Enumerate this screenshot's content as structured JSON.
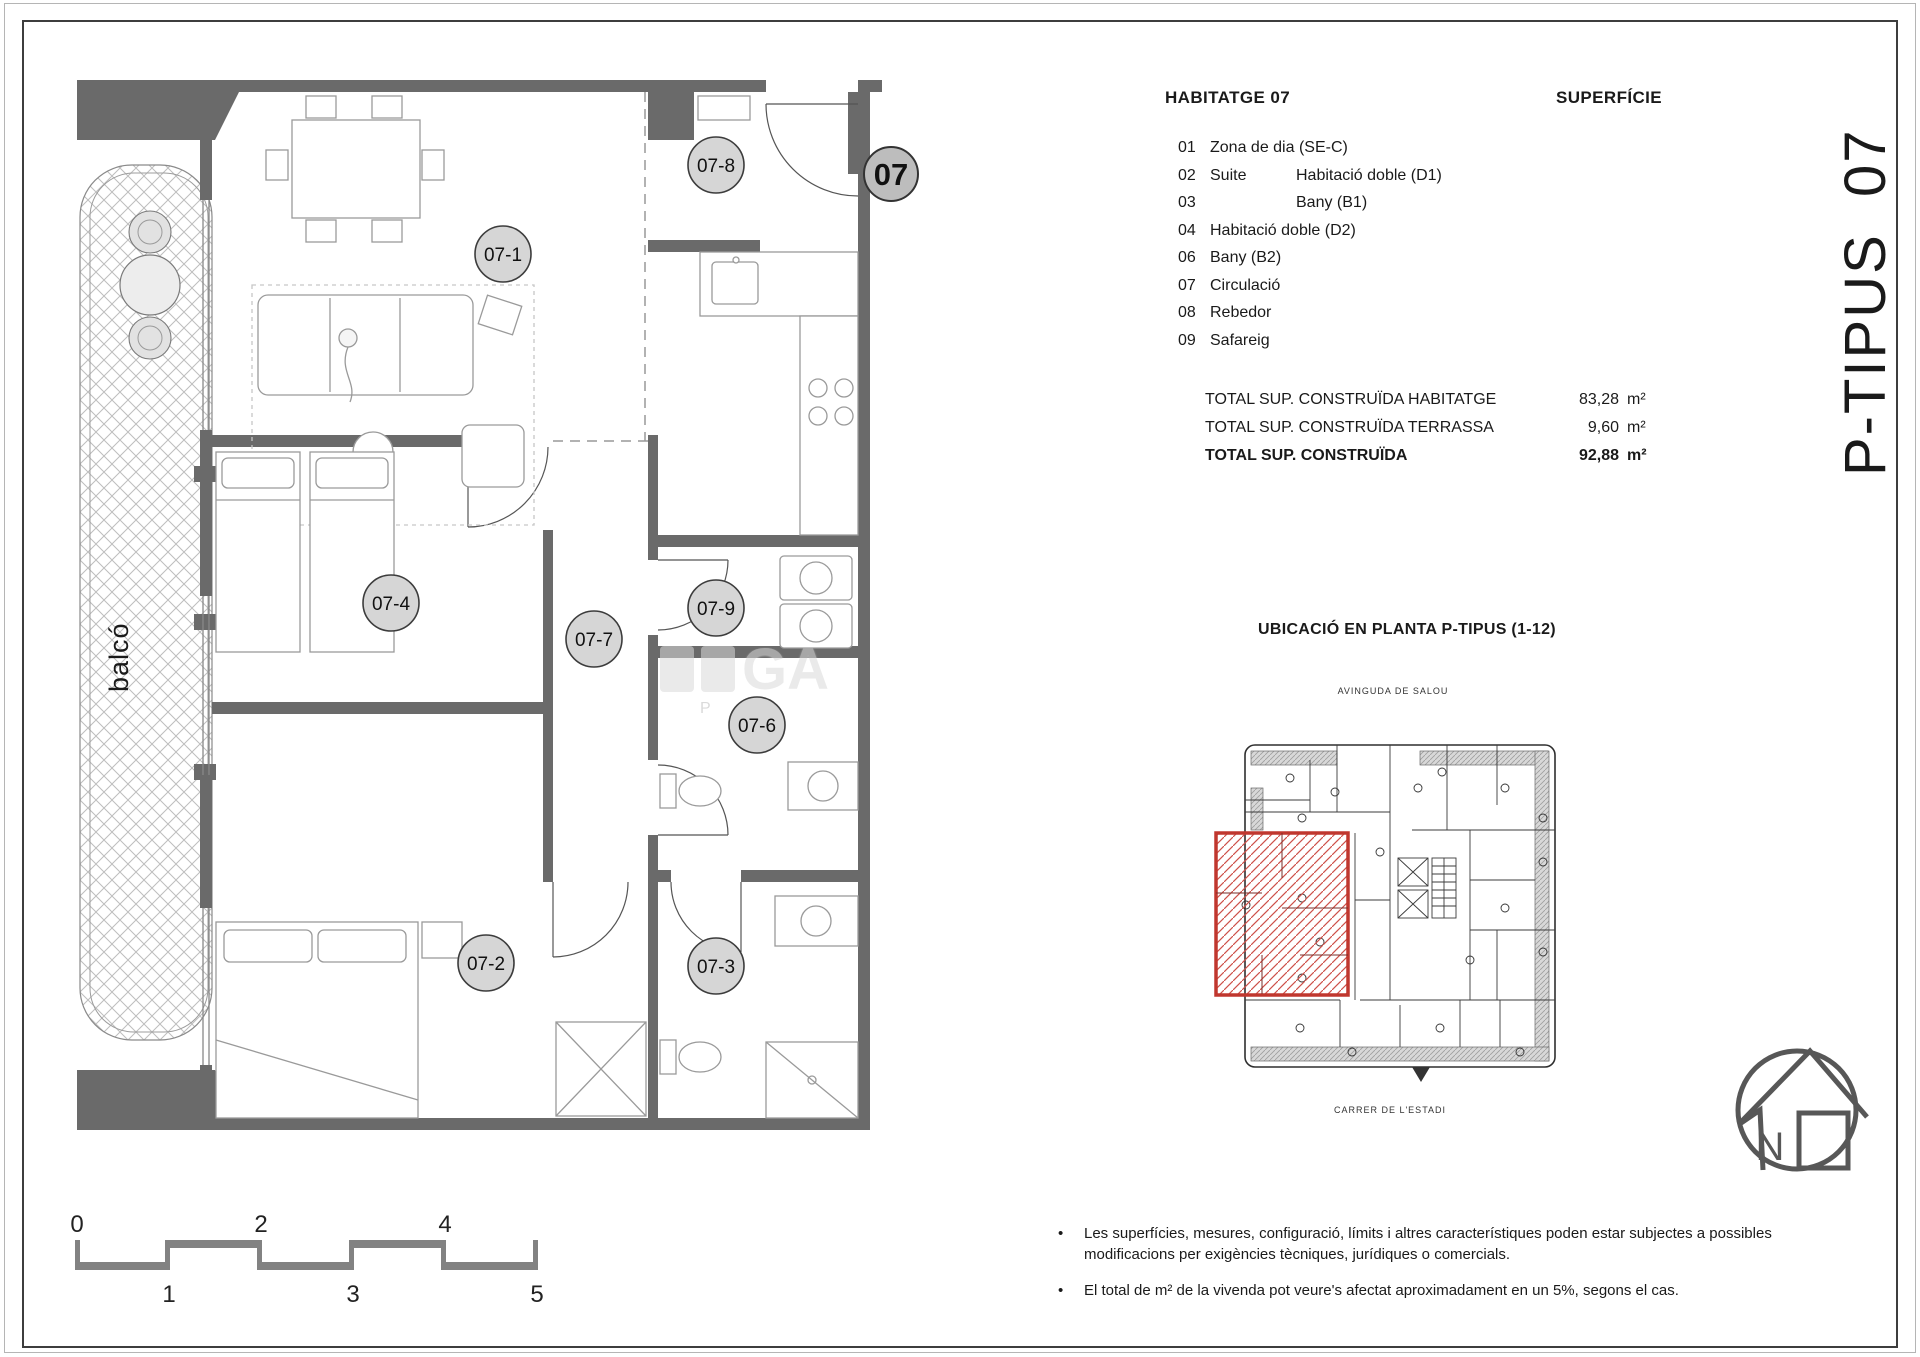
{
  "page": {
    "background": "#ffffff",
    "border_color": "#3d3d3d"
  },
  "colors": {
    "wall": "#6a6a6a",
    "accent_red": "#c0372e",
    "badge_fill": "#d6d6d6",
    "scale_gray": "#828282"
  },
  "title_block": {
    "vertical_title": "P-TIPUS  07"
  },
  "summary": {
    "heading_left": "HABITATGE 07",
    "heading_right": "SUPERFÍCIE",
    "rooms": [
      {
        "num": "01",
        "col1": "Zona de dia (SE-C)",
        "col2": ""
      },
      {
        "num": "02",
        "col1": "Suite",
        "col2": "Habitació doble (D1)"
      },
      {
        "num": "03",
        "col1": "",
        "col2": "Bany (B1)"
      },
      {
        "num": "04",
        "col1": "Habitació doble (D2)",
        "col2": ""
      },
      {
        "num": "06",
        "col1": "Bany (B2)",
        "col2": ""
      },
      {
        "num": "07",
        "col1": "Circulació",
        "col2": ""
      },
      {
        "num": "08",
        "col1": "Rebedor",
        "col2": ""
      },
      {
        "num": "09",
        "col1": "Safareig",
        "col2": ""
      }
    ],
    "totals": [
      {
        "label": "TOTAL SUP. CONSTRUÏDA HABITATGE",
        "value": "83,28",
        "unit": "m²"
      },
      {
        "label": "TOTAL SUP. CONSTRUÏDA TERRASSA",
        "value": "9,60",
        "unit": "m²"
      },
      {
        "label": "TOTAL SUP. CONSTRUÏDA",
        "value": "92,88",
        "unit": "m²"
      }
    ]
  },
  "location": {
    "heading": "UBICACIÓ EN PLANTA P-TIPUS (1-12)",
    "street_top": "AVINGUDA DE SALOU",
    "street_bottom": "CARRER DE L'ESTADI"
  },
  "plan": {
    "unit_badge": "07",
    "balcony_label": "balcó",
    "room_badges": [
      "07-1",
      "07-8",
      "07-4",
      "07-7",
      "07-9",
      "07-6",
      "07-2",
      "07-3"
    ]
  },
  "scale_bar": {
    "top": [
      "0",
      "2",
      "4"
    ],
    "bottom": [
      "1",
      "3",
      "5"
    ]
  },
  "compass": {
    "label": "N"
  },
  "notes": [
    "Les superfícies, mesures, configuració, límits i altres característiques poden estar subjectes a possibles modificacions per exigències tècniques, jurídiques o comercials.",
    "El total de m² de la vivenda pot veure's afectat aproximadament en un 5%, segons el cas."
  ],
  "watermark": {
    "text": "GA",
    "sub": "P"
  }
}
